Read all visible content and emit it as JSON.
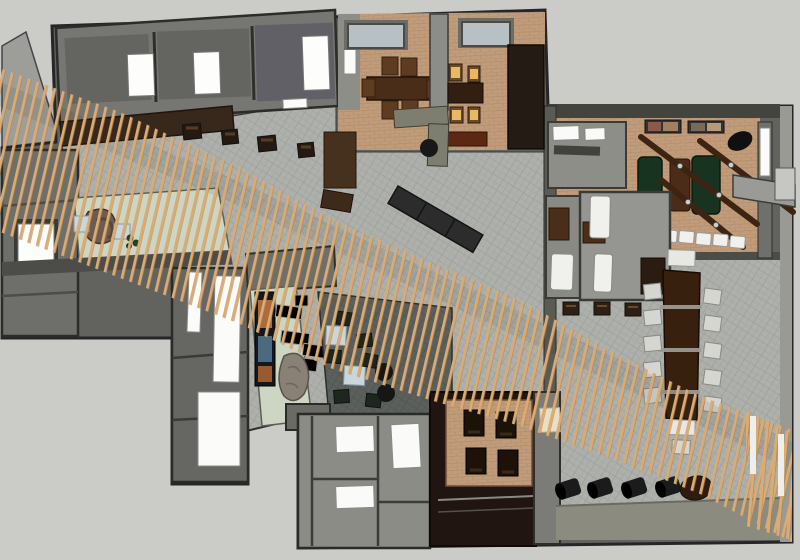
{
  "meta": {
    "type": "3d-architectural-render",
    "subject": "Overhead axonometric 3D render of a restaurant interior floor plan",
    "render_style": "sketchup-like",
    "canvas": {
      "width": 800,
      "height": 560
    }
  },
  "palette": {
    "background": "#cbcbc7",
    "wall_dark": "#2c2c28",
    "wall_mid": "#62625e",
    "wall_light": "#9d9d99",
    "floor_hatch": "#aeb0ac",
    "floor_hatch_line": "#9da09b",
    "floor_brick": "#c09c7a",
    "floor_brick_line": "#b28e6c",
    "floor_mint": "#ccd6c2",
    "floor_lounge": "#5b5f5d",
    "wood_slat": "#dcab72",
    "truss": "#3d2412",
    "communal_table": "#38200f",
    "table_walnut": "#4a2d18",
    "felt_green": "#18331f",
    "seat_white": "#f0f0ec",
    "seat_amber": "#e8b865",
    "accent_blue_table": "#c9d6dc",
    "stool_black": "#161616",
    "art_orange": "#ad6a3c",
    "art_blue": "#4a6a80",
    "skylight": "#b7c0c4",
    "band_olive": "#8b8b7f"
  },
  "areas": [
    {
      "id": "north-rooms",
      "label": "North rooms with white windows"
    },
    {
      "id": "dining-room",
      "label": "Dining room with walnut table",
      "chairs": 6
    },
    {
      "id": "private-dining",
      "label": "Private dining room with lit seats",
      "chairs": 4
    },
    {
      "id": "kitchen-bar",
      "label": "Central hall with bar counters and black bench"
    },
    {
      "id": "west-rooms",
      "label": "West room block with window"
    },
    {
      "id": "reception",
      "label": "Reception with stone desk on mint floor",
      "tables": 2
    },
    {
      "id": "southwest-wing",
      "label": "South-west wing with tall glazing"
    },
    {
      "id": "gallery-strip",
      "label": "Gallery strip with artwork, benches and rock feature",
      "benches": 4
    },
    {
      "id": "lounge",
      "label": "Dark-floor lounge with blue tables",
      "tables": 2,
      "stools": 2
    },
    {
      "id": "restrooms",
      "label": "Restroom block",
      "fixtures": 3
    },
    {
      "id": "tatami",
      "label": "Low timber platform with four sunken tables",
      "tables": 4
    },
    {
      "id": "games-room",
      "label": "East room with green tables and timber trusses",
      "green_tables": 2,
      "trusses": 3,
      "banquette_seats": 5
    },
    {
      "id": "treatment-rooms",
      "label": "Rooms with white treatment beds",
      "beds": 3
    },
    {
      "id": "communal-table-area",
      "label": "Hall with long communal table",
      "side_chairs": 10
    },
    {
      "id": "terrace",
      "label": "South terrace with barrel stools",
      "stools": 4
    }
  ],
  "features": {
    "slat_screen": {
      "label": "Diagonal timber-slat canopy crossing plan NW to SE",
      "color": "#dcab72"
    },
    "skylights": {
      "count": 2,
      "color": "#b7c0c4"
    },
    "artwork_panel": {
      "colors": [
        "#ad6a3c",
        "#4a6a80"
      ]
    },
    "trusses": {
      "count": 3,
      "color": "#3d2412"
    }
  }
}
